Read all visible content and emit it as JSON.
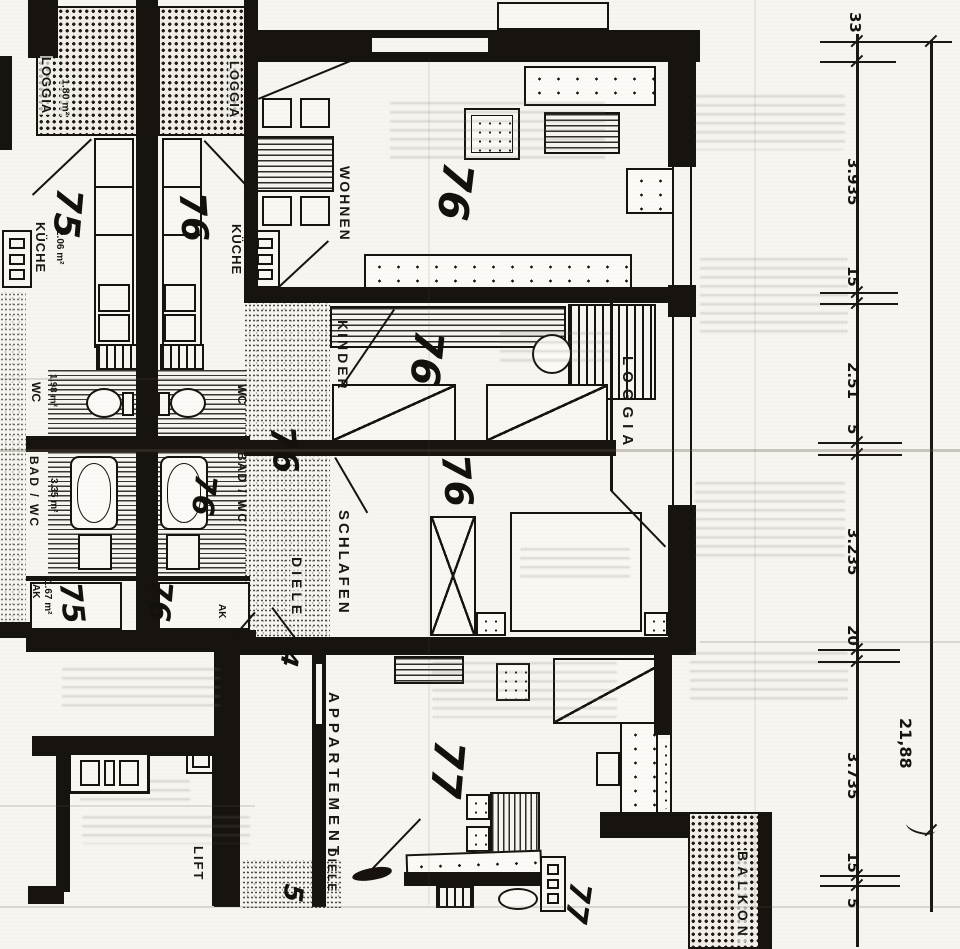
{
  "rooms": {
    "loggia_left": {
      "label": "LOGGIA",
      "area": "1.80 m²"
    },
    "loggia_right": {
      "label": "LOGGIA"
    },
    "kueche_left": {
      "label": "KÜCHE",
      "area": "2.06 m²"
    },
    "kueche_right": {
      "label": "KÜCHE"
    },
    "wc_left": {
      "label": "WC",
      "area": "1.98 m²"
    },
    "wc_right": {
      "label": "WC"
    },
    "bad_left": {
      "label": "BAD / WC",
      "area": "3.35 m²"
    },
    "bad_right": {
      "label": "BAD / WC"
    },
    "ak_left": {
      "label": "AK",
      "area": "1.67 m²"
    },
    "ak_right": {
      "label": "AK"
    },
    "wohnen": {
      "label": "WOHNEN"
    },
    "kinder": {
      "label": "KINDER"
    },
    "loggia_kinder": {
      "label": "LOGGIA"
    },
    "schlafen": {
      "label": "SCHLAFEN"
    },
    "diele": {
      "label": "DIELE"
    },
    "diele_unten": {
      "label": "DIELE"
    },
    "appartement": {
      "label": "APPARTEMENT"
    },
    "lift": {
      "label": "LIFT"
    },
    "balkon": {
      "label": "BALKON"
    }
  },
  "handwritten": {
    "unit75_loggia": "75",
    "unit76_kueche": "76",
    "unit76_bad": "76",
    "unit75_ak": "75",
    "unit76_ak": "76",
    "unit76_wohnen": "76",
    "unit76_diele": "76",
    "unit76_kinder": "76",
    "unit76_schlafen": "76",
    "unit77_zimmer": "77",
    "unit77_kueche": "77",
    "mass_4": "4",
    "mass_5": "5"
  },
  "dimensions": {
    "column_ticks": [
      "33",
      "3.935",
      "15",
      "2.51",
      "5",
      "3.235",
      "20",
      "3.735",
      "15",
      "5"
    ],
    "total": "21,88"
  }
}
